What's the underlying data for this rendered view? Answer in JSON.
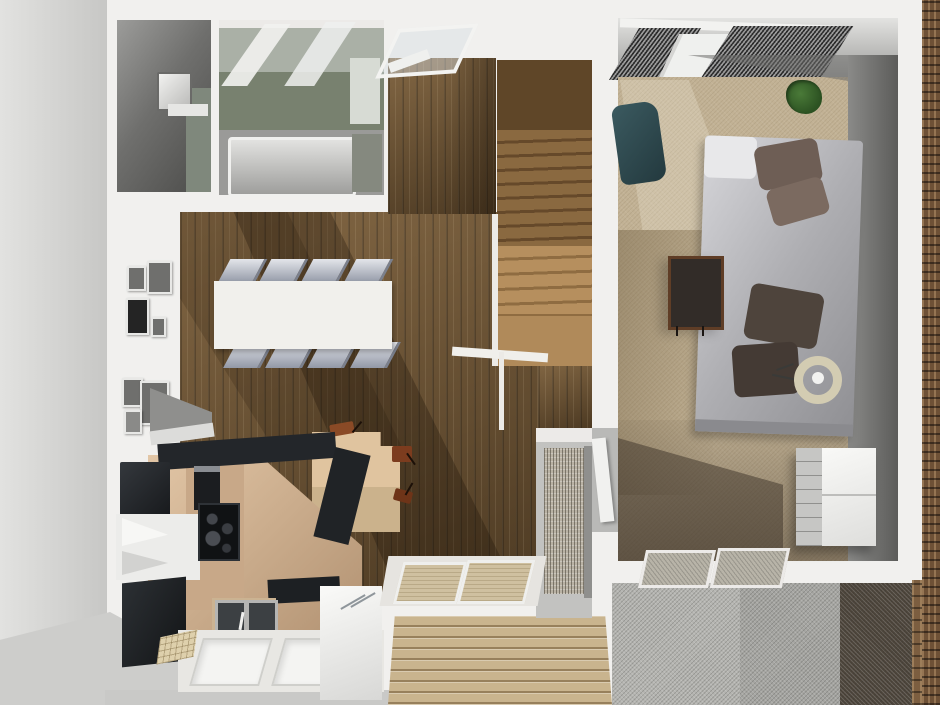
{
  "scene": {
    "title": "3D rendered apartment floor plan (top-down view, no on-screen text)",
    "view": "top-down 3d render",
    "palette": {
      "wall": "#f1f0ee",
      "outside": "#cdcdcb",
      "wood": "#6a5030",
      "stairUpper": "#5f4628",
      "stairLower": "#b68f5e",
      "landing": "#b08a5a",
      "tileGreen": "#78816f",
      "tubGray": "#b9b9b7",
      "tableWhite": "#f1f0ec",
      "chairGray": "#9aa0ae",
      "counterTan": "#c8a888",
      "applianceBlack": "#1d2024",
      "steelSink": "#3c4043",
      "carpet": "#c2b295",
      "carpetShadow": "#5f5444",
      "wallDark": "#5c5c5a",
      "duvetGray": "#aeaeb2",
      "pillowBrown": "#6e5e55",
      "pillowDark": "#443a34",
      "tealChair": "#2c464c",
      "plantGreen": "#2c5222",
      "fanBeige": "#d3ccb2",
      "wardrobeWhite": "#ececea",
      "curtainDark": "#2c2c2c",
      "deckTan": "#c9b48e",
      "gravelLight": "#b4b4b0",
      "gravelMed": "#a5a5a1",
      "gravelDark": "#4c443a",
      "stone": "#7c5e40",
      "brick": "#6e5136",
      "matTan": "#cfc0a0",
      "cardTableTan": "#d8bd98"
    },
    "rooms": [
      {
        "name": "utility-room",
        "items": [
          "washer",
          "side-cabinet"
        ]
      },
      {
        "name": "bathroom",
        "items": [
          "glass-shower",
          "green-tile-wall",
          "vanity",
          "bathtub"
        ]
      },
      {
        "name": "dining-living-room",
        "items": [
          "dining-table",
          "eight-gray-chairs",
          "gallery-wall-frames",
          "card-table",
          "three-stools",
          "dark-wood-floor"
        ]
      },
      {
        "name": "kitchen",
        "items": [
          "refrigerator",
          "black-counter",
          "oven",
          "cooktop",
          "corner-cabinet",
          "black-cabinet",
          "double-sink",
          "window-island",
          "dishwasher",
          "tile-mat"
        ]
      },
      {
        "name": "staircase",
        "items": [
          "upper-flight",
          "lower-flight",
          "landing",
          "glass-railing",
          "white-stringer"
        ]
      },
      {
        "name": "entry-hall",
        "items": [
          "two-doormats",
          "louvered-closet",
          "bedroom-door"
        ]
      },
      {
        "name": "bedroom",
        "items": [
          "striped-curtains",
          "window",
          "bed-gray-duvet",
          "four-pillows",
          "desk",
          "teal-armchair",
          "potted-plant",
          "floor-fan",
          "white-wardrobe",
          "two-window-mats",
          "tan-carpet"
        ]
      },
      {
        "name": "exterior",
        "items": [
          "wood-deck",
          "light-gravel",
          "medium-gravel",
          "dark-gravel",
          "stone-pillar",
          "brick-wall-edge"
        ]
      }
    ]
  }
}
